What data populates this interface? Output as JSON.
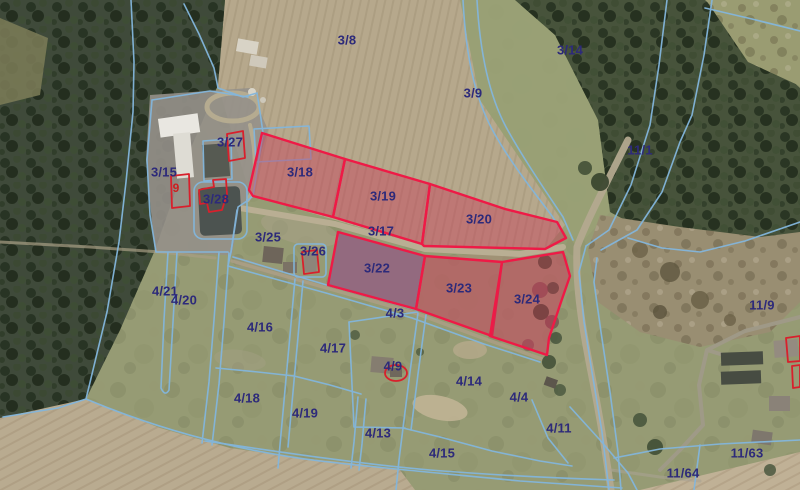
{
  "map": {
    "view": "aerial-orthophoto-with-cadastral-overlay",
    "colors": {
      "parcel_boundary": "#83b6dc",
      "parcel_label": "#2d2a7a",
      "highlight_stroke": "#ee1a46",
      "highlight_fill": "rgba(202,48,82,0.40)",
      "building_outline": "#d8202c",
      "building_label": "#cc1f1f"
    },
    "parcel_labels": [
      {
        "text": "3/8",
        "x": 347,
        "y": 40
      },
      {
        "text": "3/14",
        "x": 570,
        "y": 50
      },
      {
        "text": "3/9",
        "x": 473,
        "y": 93
      },
      {
        "text": "11/1",
        "x": 640,
        "y": 150
      },
      {
        "text": "3/27",
        "x": 230,
        "y": 142
      },
      {
        "text": "3/15",
        "x": 164,
        "y": 172
      },
      {
        "text": "3/18",
        "x": 300,
        "y": 172
      },
      {
        "text": "3/19",
        "x": 383,
        "y": 196
      },
      {
        "text": "3/28",
        "x": 216,
        "y": 199
      },
      {
        "text": "3/20",
        "x": 479,
        "y": 219
      },
      {
        "text": "3/17",
        "x": 381,
        "y": 231
      },
      {
        "text": "3/25",
        "x": 268,
        "y": 237
      },
      {
        "text": "3/26",
        "x": 313,
        "y": 251
      },
      {
        "text": "3/22",
        "x": 377,
        "y": 268
      },
      {
        "text": "3/23",
        "x": 459,
        "y": 288
      },
      {
        "text": "4/21",
        "x": 165,
        "y": 291
      },
      {
        "text": "3/24",
        "x": 527,
        "y": 299
      },
      {
        "text": "4/20",
        "x": 184,
        "y": 300
      },
      {
        "text": "11/9",
        "x": 762,
        "y": 305
      },
      {
        "text": "4/3",
        "x": 395,
        "y": 313
      },
      {
        "text": "4/16",
        "x": 260,
        "y": 327
      },
      {
        "text": "4/17",
        "x": 333,
        "y": 348
      },
      {
        "text": "4/9",
        "x": 393,
        "y": 366
      },
      {
        "text": "4/14",
        "x": 469,
        "y": 381
      },
      {
        "text": "4/4",
        "x": 519,
        "y": 397
      },
      {
        "text": "4/18",
        "x": 247,
        "y": 398
      },
      {
        "text": "4/19",
        "x": 305,
        "y": 413
      },
      {
        "text": "4/11",
        "x": 559,
        "y": 428
      },
      {
        "text": "4/13",
        "x": 378,
        "y": 433
      },
      {
        "text": "11/63",
        "x": 747,
        "y": 453
      },
      {
        "text": "4/15",
        "x": 442,
        "y": 453
      },
      {
        "text": "11/64",
        "x": 683,
        "y": 473
      }
    ],
    "building_labels": [
      {
        "text": "9",
        "x": 176,
        "y": 188
      }
    ],
    "highlighted_parcels": [
      {
        "id": "3-18",
        "points": "262,133 345,159 333,217 253,196 249,190"
      },
      {
        "id": "3-19",
        "points": "345,159 430,184 422,244 333,217"
      },
      {
        "id": "3-20",
        "points": "430,184 505,209 557,222 566,238 545,249 424,246 422,244"
      },
      {
        "id": "3-22",
        "points": "338,232 425,256 416,309 328,285",
        "fill": "rgba(160,70,130,0.42)"
      },
      {
        "id": "3-23",
        "points": "425,256 502,262 492,336 416,309"
      },
      {
        "id": "3-24",
        "points": "502,262 563,252 570,276 561,302 549,338 547,355 490,336"
      }
    ],
    "outlined_buildings": [
      {
        "id": "building-9",
        "type": "polygon",
        "points": "171,176 189,174 190,206 172,208"
      },
      {
        "id": "building-3-27",
        "type": "polygon",
        "points": "227,134 243,131 245,158 229,161"
      },
      {
        "id": "building-3-28",
        "type": "polygon",
        "points": "203,189 214,187 213,180 226,179 227,194 222,210 209,212 207,203 200,204 199,190"
      },
      {
        "id": "building-3-26",
        "type": "polygon",
        "points": "302,252 317,250 319,272 304,274"
      },
      {
        "id": "building-4-9",
        "type": "ellipse",
        "cx": 396,
        "cy": 373,
        "rx": 11,
        "ry": 8
      },
      {
        "id": "building-right-1",
        "type": "polygon",
        "points": "786,338 800,336 800,361 788,362"
      },
      {
        "id": "building-right-2",
        "type": "polygon",
        "points": "792,366 800,365 800,387 793,388"
      }
    ]
  }
}
